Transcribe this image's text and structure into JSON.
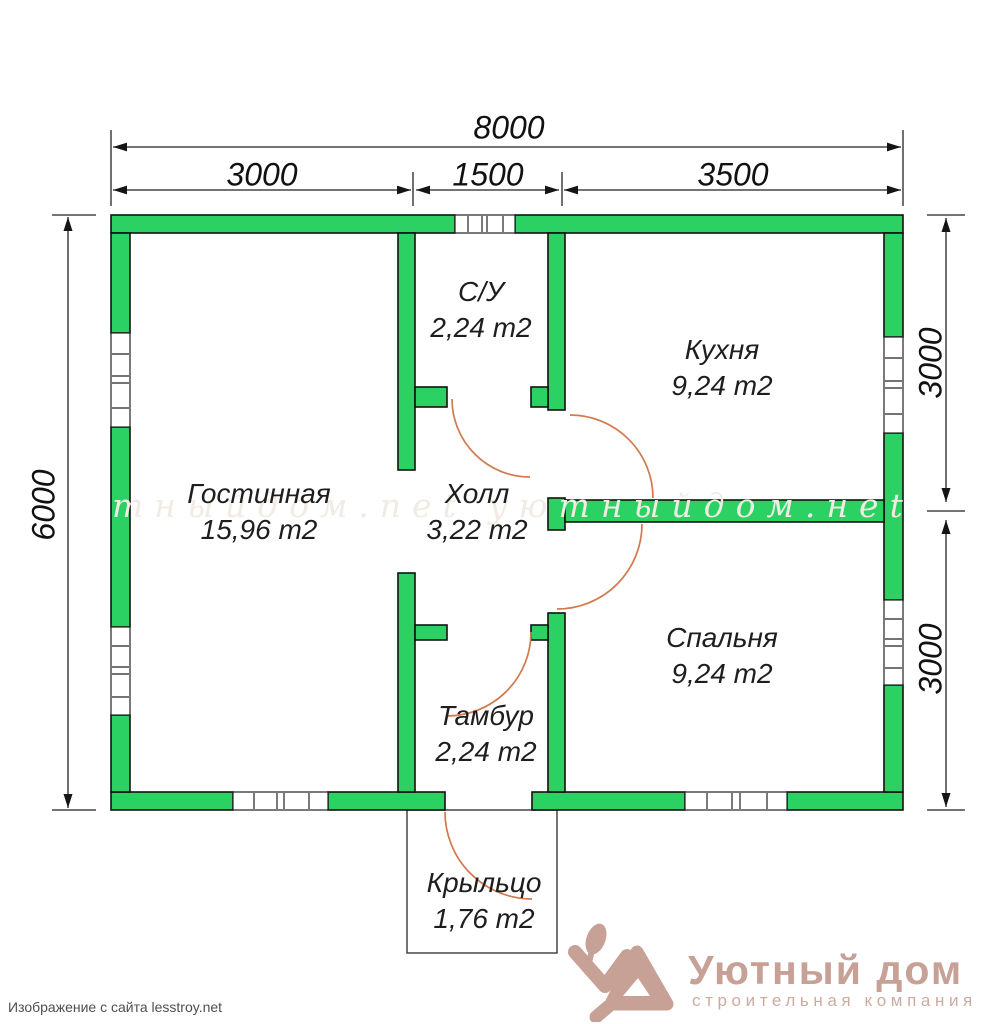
{
  "colors": {
    "wall": "#2bd163",
    "outline": "#121212",
    "arc": "#d07a4e",
    "dim": "#1d1d1d",
    "logo": "#c7a096",
    "logo_sub": "#cbaba1",
    "credit": "#4f4f4f",
    "watermark": "#f2ebe4"
  },
  "dimensions": {
    "total_width": "8000",
    "top_segments": [
      {
        "label": "3000"
      },
      {
        "label": "1500"
      },
      {
        "label": "3500"
      }
    ],
    "left_height": "6000",
    "right_segments": [
      {
        "label": "3000"
      },
      {
        "label": "3000"
      }
    ]
  },
  "rooms": [
    {
      "name": "С/У",
      "area": "2,24 m2"
    },
    {
      "name": "Кухня",
      "area": "9,24 m2"
    },
    {
      "name": "Гостинная",
      "area": "15,96 m2"
    },
    {
      "name": "Холл",
      "area": "3,22 m2"
    },
    {
      "name": "Спальня",
      "area": "9,24 m2"
    },
    {
      "name": "Тамбур",
      "area": "2,24 m2"
    },
    {
      "name": "Крыльцо",
      "area": "1,76 m2"
    }
  ],
  "watermark": "тныйдом.net уютныйдом.нet",
  "credit": "Изображение с сайта lesstroy.net",
  "logo": {
    "title": "Уютный дом",
    "subtitle": "строительная компания"
  }
}
